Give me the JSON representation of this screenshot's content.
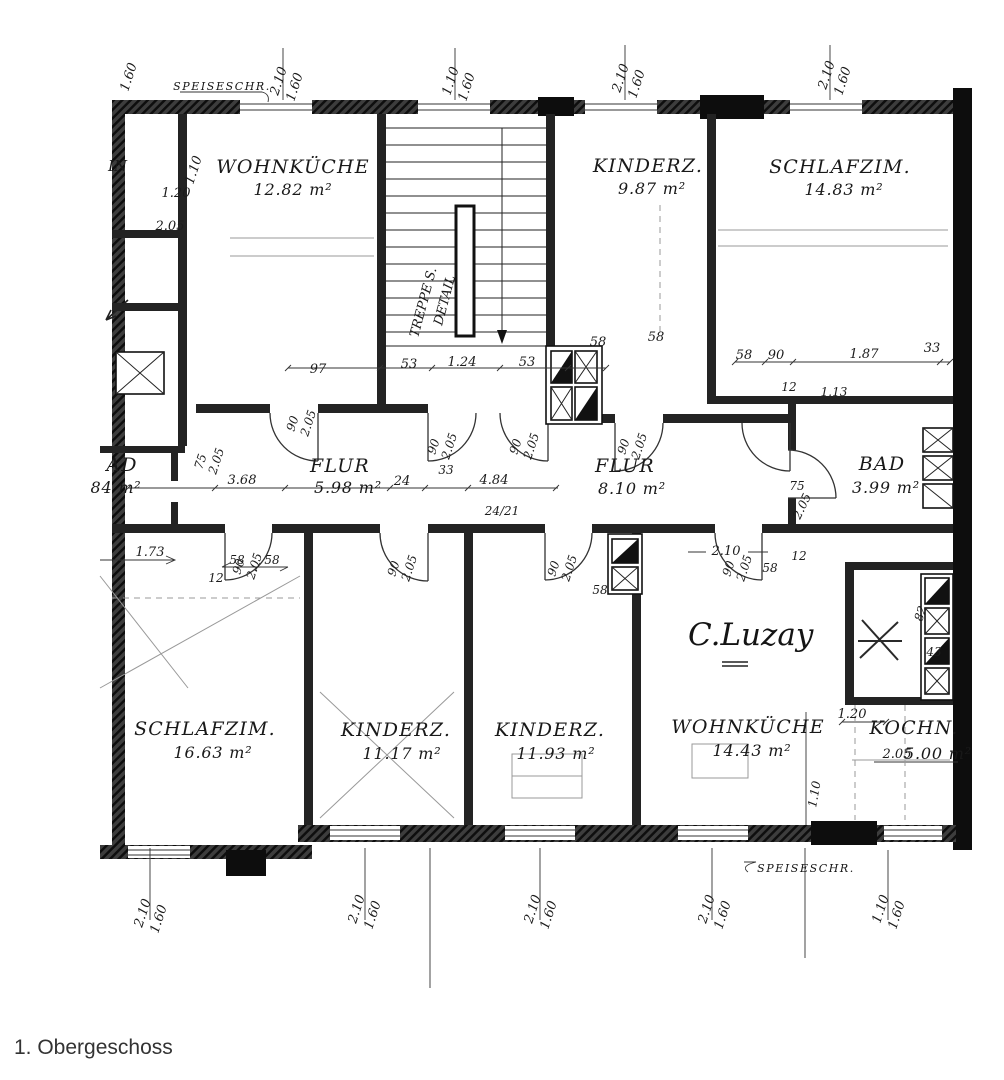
{
  "caption": "1. Obergeschoss",
  "rooms": [
    {
      "name": "WOHNKÜCHE",
      "area": "12.82 m²"
    },
    {
      "name": "KINDERZ.",
      "area": "9.87 m²"
    },
    {
      "name": "SCHLAFZIM.",
      "area": "14.83 m²"
    },
    {
      "name": "FLUR",
      "area": "5.98 m²"
    },
    {
      "name": "FLUR",
      "area": "8.10 m²"
    },
    {
      "name": "BAD",
      "area": "3.99 m²"
    },
    {
      "name": "AD",
      "area": "84 m²"
    },
    {
      "name": "SCHLAFZIM.",
      "area": "16.63 m²"
    },
    {
      "name": "KINDERZ.",
      "area": "11.17 m²"
    },
    {
      "name": "KINDERZ.",
      "area": "11.93 m²"
    },
    {
      "name": "WOHNKÜCHE",
      "area": "14.43 m²"
    },
    {
      "name": "KOCHN.",
      "area": "5.00 m²"
    }
  ],
  "window_dim": {
    "w": "2.10",
    "h": "1.60"
  },
  "window_dim_small": {
    "w": "1.10",
    "h": "1.60"
  },
  "door_dim": {
    "w": "90",
    "h": "2.05"
  },
  "door_dim_bath": {
    "w": "75",
    "h": "2.05"
  },
  "single_dim": "1.60",
  "measurements": [
    "97",
    "53",
    "1.24",
    "53",
    "58",
    "58",
    "58",
    "90",
    "1.87",
    "33",
    "12",
    "1.13",
    "1.20",
    "2.05",
    "1.10",
    "3.68",
    "24",
    "4.84",
    "33",
    "24/21",
    "1.73",
    "58",
    "58",
    "12",
    "2.10",
    "58",
    "12",
    "58",
    "1.20",
    "2.05",
    "82",
    "43",
    "1.10"
  ],
  "annotations": {
    "stair1": "TREPPE S.",
    "stair2": "DETAIL",
    "pantry_top": "SPEISESCHR.",
    "pantry_bottom": "SPEISESCHR.",
    "signature": "C.Luzay",
    "fragment": "IN"
  }
}
